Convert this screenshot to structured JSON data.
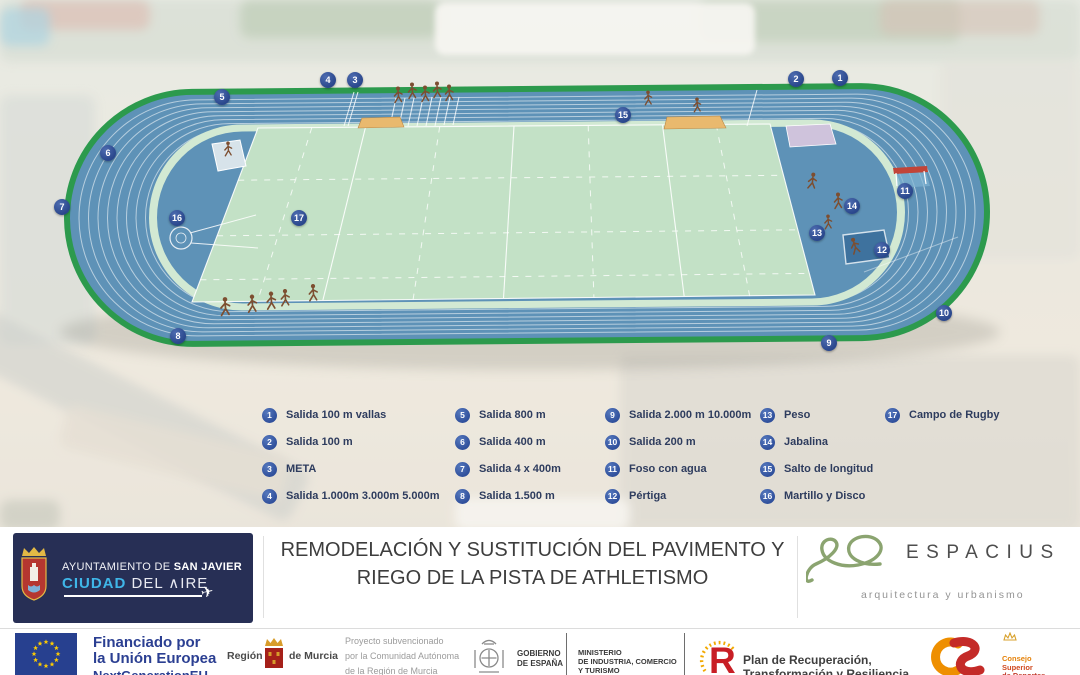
{
  "legend": {
    "items": [
      {
        "num": "1",
        "label": "Salida 100 m vallas"
      },
      {
        "num": "2",
        "label": "Salida 100 m"
      },
      {
        "num": "3",
        "label": "META"
      },
      {
        "num": "4",
        "label": "Salida 1.000m 3.000m 5.000m"
      },
      {
        "num": "5",
        "label": "Salida 800 m"
      },
      {
        "num": "6",
        "label": "Salida 400 m"
      },
      {
        "num": "7",
        "label": "Salida 4 x 400m"
      },
      {
        "num": "8",
        "label": "Salida 1.500 m"
      },
      {
        "num": "9",
        "label": "Salida 2.000 m 10.000m"
      },
      {
        "num": "10",
        "label": "Salida 200 m"
      },
      {
        "num": "11",
        "label": "Foso con agua"
      },
      {
        "num": "12",
        "label": "Pértiga"
      },
      {
        "num": "13",
        "label": "Peso"
      },
      {
        "num": "14",
        "label": "Jabalina"
      },
      {
        "num": "15",
        "label": "Salto de longitud"
      },
      {
        "num": "16",
        "label": "Martillo y Disco"
      },
      {
        "num": "17",
        "label": "Campo de Rugby"
      }
    ]
  },
  "board": {
    "title_line1": "REMODELACIÓN Y SUSTITUCIÓN DEL PAVIMENTO Y",
    "title_line2": "RIEGO DE LA PISTA DE ATHLETISMO",
    "sanjavier": {
      "pre": "AYUNTAMIENTO DE ",
      "bold": "SAN JAVIER",
      "ciudad": "CIUDAD",
      "resto": " DEL ∧IRE",
      "plane_icon": "✈"
    },
    "espacius": {
      "name": "ESPACIUS",
      "tagline": "arquitectura y urbanismo"
    }
  },
  "funding": {
    "eu_line1": "Financiado por",
    "eu_line2": "la Unión Europea",
    "eu_line3": "NextGenerationEU",
    "murcia_pre": "Región",
    "murcia_post": "de Murcia",
    "subsidy_l1": "Proyecto subvencionado",
    "subsidy_l2": "por la Comunidad Autónoma",
    "subsidy_l3": "de la Región de Murcia",
    "gob_l1": "GOBIERNO",
    "gob_l2": "DE ESPAÑA",
    "min_l1": "MINISTERIO",
    "min_l2": "DE INDUSTRIA, COMERCIO",
    "min_l3": "Y TURISMO",
    "prtr_l1": "Plan de Recuperación,",
    "prtr_l2": "Transformación y Resiliencia",
    "csd_l1": "Consejo",
    "csd_l2": "Superior",
    "csd_l3": "de Deportes"
  },
  "colors": {
    "track_blue": "#5e92b7",
    "field_green": "#c3e1c6",
    "border_green": "#2c9a4d",
    "marker_blue": "#2d4b90",
    "navy_logo": "#272f55",
    "eu_blue": "#27408f",
    "espacius_green": "#8ba470"
  }
}
